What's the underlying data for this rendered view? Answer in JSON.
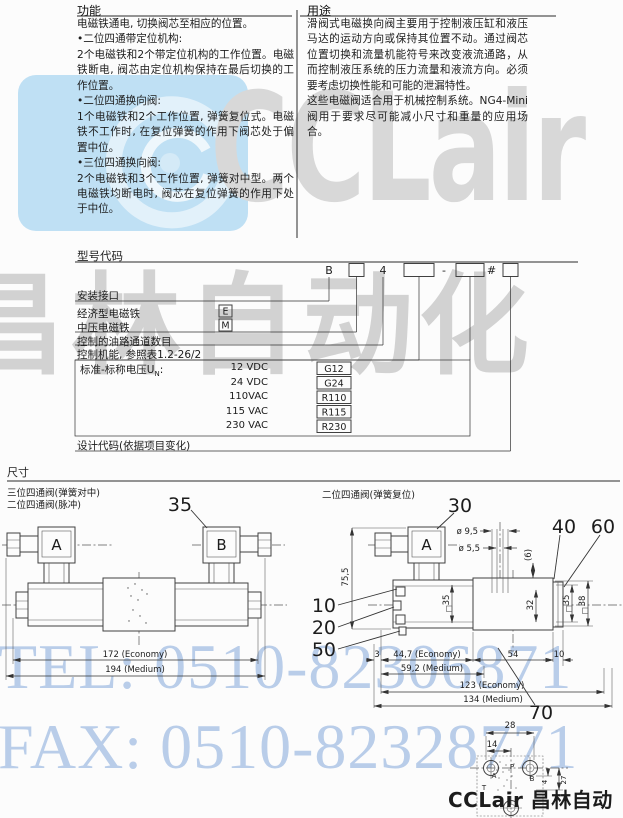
{
  "header": {
    "function": {
      "title": "功能",
      "paragraphs": [
        "电磁铁通电, 切换阀芯至相应的位置。",
        "•二位四通带定位机构:",
        "2个电磁铁和2个带定位机构的工作位置。电磁铁断电, 阀芯由定位机构保持在最后切换的工作位置。",
        "•二位四通换向阀:",
        "1个电磁铁和2个工作位置, 弹簧复位式。电磁铁不工作时, 在复位弹簧的作用下阀芯处于偏置中位。",
        "•三位四通换向阀:",
        "2个电磁铁和3个工作位置, 弹簧对中型。两个电磁铁均断电时, 阀芯在复位弹簧的作用下处于中位。"
      ]
    },
    "application": {
      "title": "用途",
      "paragraphs": [
        "滑阀式电磁换向阀主要用于控制液压缸和液压马达的运动方向或保持其位置不动。通过阀芯位置切换和流量机能符号来改变液流通路，从而控制液压系统的压力流量和液流方向。必须要考虑切换性能和可能的泄漏特性。",
        "这些电磁阀适合用于机械控制系统。NG4-Mini阀用于要求尽可能减小尺寸和重量的应用场合。"
      ]
    }
  },
  "model_code": {
    "title": "型号代码",
    "code_row": {
      "prefix": "B",
      "size": "4",
      "dash": "-",
      "hash": "#"
    },
    "rows": {
      "mounting": "安装接口",
      "economy": "经济型电磁铁",
      "economy_code": "E",
      "medium": "中压电磁铁",
      "medium_code": "M",
      "ports": "控制的油路通道数目",
      "function": "控制机能, 参照表1.2-26/2",
      "voltage_prefix": "标准-标称电压U",
      "voltage_sub": "N",
      "voltage_colon": ":",
      "design": "设计代码(依据项目变化)"
    },
    "voltages": [
      {
        "label": "12 VDC",
        "code": "G12"
      },
      {
        "label": "24 VDC",
        "code": "G24"
      },
      {
        "label": "110VAC",
        "code": "R110"
      },
      {
        "label": "115 VAC",
        "code": "R115"
      },
      {
        "label": "230 VAC",
        "code": "R230"
      }
    ]
  },
  "dimensions": {
    "title": "尺寸",
    "left": {
      "caption1": "三位四通阀(弹簧对中)",
      "caption2": "二位四通阀(脉冲)",
      "callout35": "35",
      "sol_a": "A",
      "sol_b": "B",
      "len_economy": "172 (Economy)",
      "len_medium": "194 (Medium)"
    },
    "right": {
      "caption": "二位四通阀(弹簧复位)",
      "sol_a": "A",
      "callout30": "30",
      "callout40": "40",
      "callout60": "60",
      "callout10": "10",
      "callout20": "20",
      "callout50": "50",
      "callout70": "70",
      "dia95": "ø 9,5",
      "dia55": "ø 5,5",
      "six": "(6)",
      "h755": "75,5",
      "sq35l": "35",
      "h32": "32",
      "sq35r": "35",
      "h38": "38",
      "d3": "3",
      "d447": "44,7 (Economy)",
      "d592": "59,2 (Medium)",
      "d54": "54",
      "d10": "10",
      "d123": "123 (Economy)",
      "d134": "134 (Medium)",
      "d28": "28",
      "d14": "14",
      "d4": "4",
      "d27": "27",
      "port_a": "A",
      "port_p": "P",
      "port_b": "B",
      "port_t": "T"
    }
  },
  "watermarks": {
    "brand": "CCLair",
    "brand_cn": "昌林自动化",
    "tel": "TEL: 0510-82306871",
    "fax": "FAX: 0510-82328771"
  },
  "footer": {
    "brand": "CCLair 昌林自动化"
  },
  "colors": {
    "watermark_blue": "#b9cde9",
    "watermark_grey": "#d6d6d6",
    "logo_blue": "#bfe0f4",
    "ink": "#1f1f1f"
  }
}
